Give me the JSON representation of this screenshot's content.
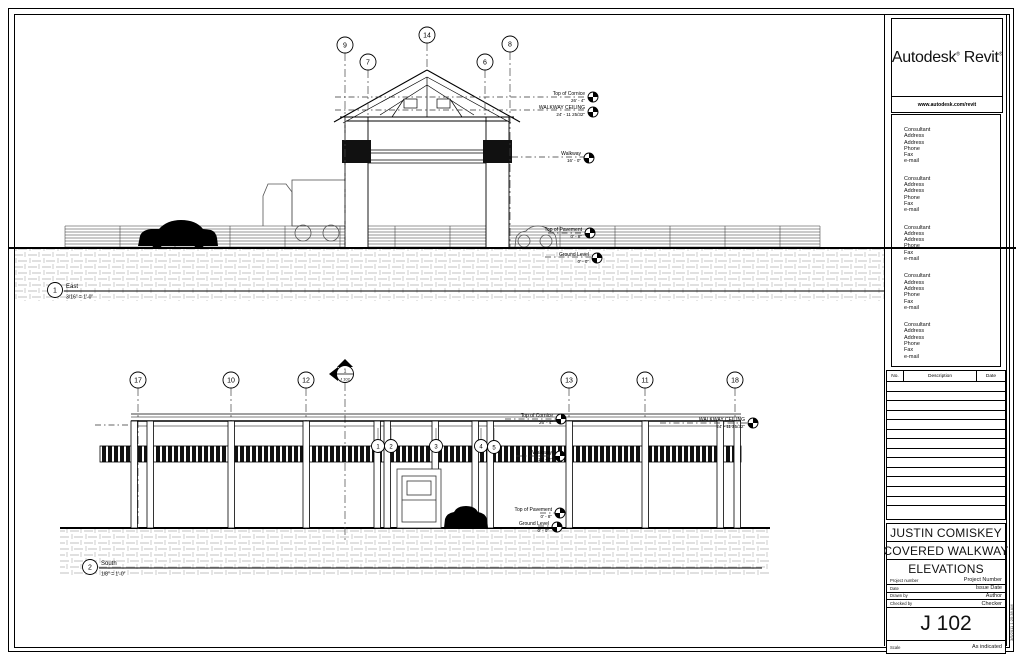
{
  "titleblock": {
    "brand_left": "Autodesk",
    "brand_right": "Revit",
    "reg": "®",
    "website": "www.autodesk.com/revit",
    "consultant": {
      "l1": "Consultant",
      "l2": "Address",
      "l3": "Address",
      "l4": "Phone",
      "l5": "Fax",
      "l6": "e-mail"
    },
    "revision_header": {
      "no": "No.",
      "description": "Description",
      "date": "Date"
    },
    "client": "JUSTIN COMISKEY",
    "project": "COVERED WALKWAY",
    "sheet_title": "ELEVATIONS",
    "project_number_label": "Project number",
    "project_number": "Project Number",
    "date_label": "Date",
    "date": "Issue Date",
    "drawn_by_label": "Drawn by",
    "drawn_by": "Author",
    "checked_by_label": "Checked by",
    "checked_by": "Checker",
    "sheet_number": "J 102",
    "scale_label": "Scale",
    "scale": "As indicated",
    "plot_stamp": "3/5/2011 1:25:38 AM"
  },
  "views": {
    "east": {
      "number": "1",
      "title": "East",
      "scale": "3/16\" = 1'-0\"",
      "grids": [
        "9",
        "7",
        "14",
        "6",
        "8"
      ]
    },
    "south": {
      "number": "2",
      "title": "South",
      "scale": "1/8\" = 1'-0\"",
      "grids": [
        "17",
        "10",
        "12",
        "13",
        "11",
        "18"
      ],
      "column_grids": [
        "1",
        "2",
        "3",
        "4",
        "5"
      ],
      "marker": {
        "detail": "1",
        "sheet": "J 102"
      }
    }
  },
  "levels": {
    "cornice": {
      "name": "Top of Cornice",
      "value": "26' - 4\""
    },
    "ceiling": {
      "name": "WALKWAY CEILING",
      "value": "24' - 11 25/32\""
    },
    "walkway": {
      "name": "Walkway",
      "value": "16' - 0\""
    },
    "pavement": {
      "name": "Top of Pavement",
      "value": "0' - 8\""
    },
    "ground": {
      "name": "Ground Level",
      "value": "0' - 0\""
    }
  }
}
